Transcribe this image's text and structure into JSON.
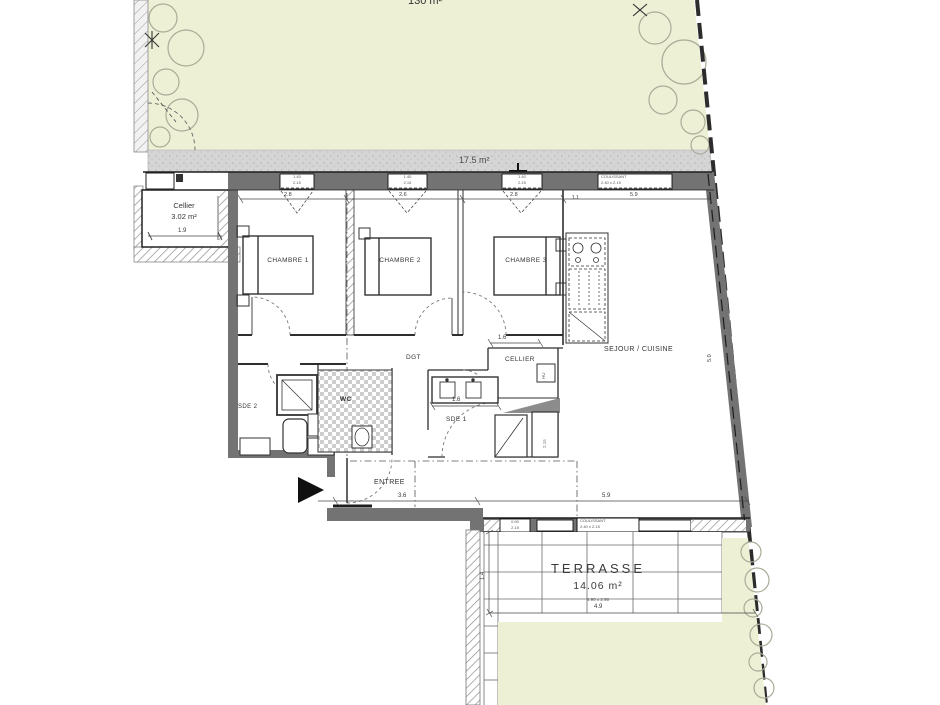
{
  "plan": {
    "garden": {
      "area": "130 m²"
    },
    "path": {
      "area": "17.5 m²"
    },
    "cellier_ext": {
      "name": "Cellier",
      "area": "3.02 m²"
    },
    "rooms": {
      "chambre1": "CHAMBRE 1",
      "chambre2": "CHAMBRE 2",
      "chambre3": "CHAMBRE 3",
      "dgt": "DGT",
      "cellier_int": "CELLIER",
      "wc": "WC",
      "sde1": "SDE 1",
      "sde2": "SDE 2",
      "sejour": "SEJOUR / CUISINE",
      "entree": "ENTREE"
    },
    "terrasse": {
      "name": "TERRASSE",
      "area": "14.06 m²",
      "note": "4.90 x 2.90"
    },
    "dims": {
      "c19": "1.9",
      "t1": "2.8",
      "t2": "2.6",
      "t3": "2.8",
      "t4": "5.9",
      "t5": "1.1",
      "ci16": "1.6",
      "v16": "1.6",
      "e36": "3.6",
      "s59": "5.9",
      "tw49": "4.9",
      "th14": "1.4",
      "r50": "5.0"
    },
    "windows": {
      "top": [
        {
          "l1": "1.40",
          "l2": "2.15"
        },
        {
          "l1": "1.40",
          "l2": "2.15"
        },
        {
          "l1": "1.40",
          "l2": "2.15"
        },
        {
          "l1": "COULISSANT",
          "l2": "2.40 x 2.15"
        }
      ],
      "bottom": [
        {
          "l1": "0.90",
          "l2": "2.15"
        },
        {
          "l1": "COULISSANT",
          "l2": "2.40 x 2.15"
        }
      ]
    },
    "fixtures": {
      "hu": "HU",
      "pf": "2.15"
    },
    "colors": {
      "garden": "#eef0d6",
      "gravel": "#d5d5d5",
      "wall": "#737373",
      "boundary": "#2c2c2c"
    }
  }
}
